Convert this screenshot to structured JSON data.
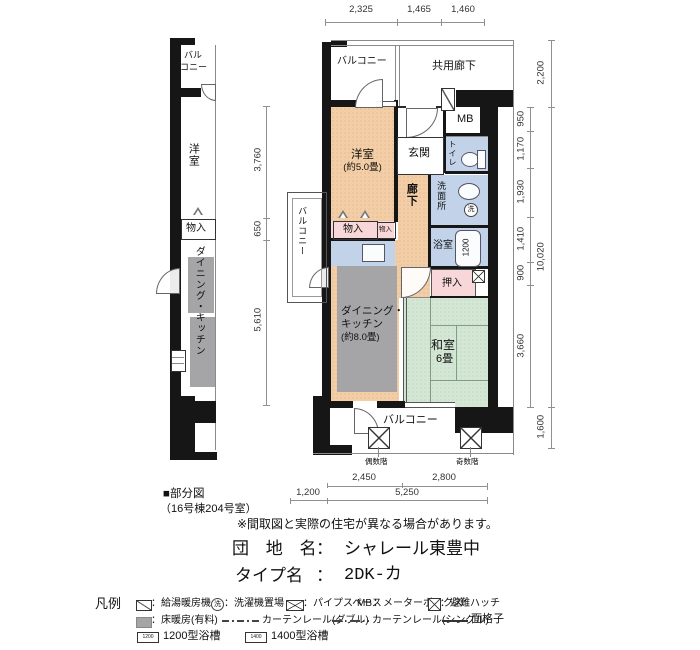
{
  "colors": {
    "western_room": "#f3cda5",
    "wet_area": "#c2d3e9",
    "storage": "#f7d7d7",
    "tatami": "#d4e7d5",
    "floor_heating": "#a5a5a7",
    "wall": "#161616"
  },
  "partial": {
    "caption1": "■部分図",
    "caption2": "（16号棟204号室）",
    "balcony1": "バル",
    "balcony2": "コニー",
    "youshitsu": "洋室",
    "monoire": "物入",
    "dk": "ダイニング・キッチン"
  },
  "main": {
    "balcony_top": "バルコニー",
    "kyoyo_roka": "共用廊下",
    "mb": "MB",
    "youshitsu1": "洋室",
    "youshitsu2": "(約5.0畳)",
    "genkan": "玄関",
    "roka": "廊下",
    "toilet": "トイレ",
    "senmenjo": "洗面所",
    "laundry": "洗",
    "yokushitsu": "浴室",
    "bath1200": "1200",
    "monoire": "物入",
    "monoire2": "物入",
    "oshiire": "押入",
    "dk1": "ダイニング・",
    "dk2": "キッチン",
    "dk3": "(約8.0畳)",
    "washitsu1": "和室",
    "washitsu2": "6畳",
    "balcony_side": "バルコニー",
    "balcony_bottom": "バルコニー",
    "hatch_even": "偶数階",
    "hatch_odd": "奇数階"
  },
  "dims": {
    "top": [
      "2,325",
      "1,465",
      "1,460"
    ],
    "left": [
      "3,760",
      "650",
      "5,610"
    ],
    "right_a": [
      "950",
      "1,170",
      "1,930",
      "1,410",
      "900",
      "3,660"
    ],
    "right_b": [
      "2,200",
      "10,020",
      "1,600"
    ],
    "bottom_a": [
      "2,450",
      "2,800"
    ],
    "bottom_b": [
      "1,200",
      "5,250"
    ]
  },
  "info": {
    "disclaimer": "※間取図と実際の住宅が異なる場合があります。",
    "name_label": "団 地 名",
    "name_colon": "：",
    "name_value": "シャレール東豊中",
    "type_label": "タイプ名",
    "type_colon": "：",
    "type_value": "2DK-カ"
  },
  "legend": {
    "heading": "凡例",
    "r1_1": "：給湯暖房機",
    "r1_2sym": "洗",
    "r1_2": "：洗濯機置場",
    "r1_3": "：パイプスペース",
    "r1_4pre": "MB",
    "r1_4": "：メーターボックス",
    "r1_5": "：避難ハッチ",
    "r2_1": "：床暖房(有料)",
    "r2_2": "カーテンレール(ダブル)",
    "r2_3": "カーテンレール(シングル)",
    "r2_4": "面格子",
    "r3_1sym": "1200",
    "r3_1": "1200型浴槽",
    "r3_2sym": "1400",
    "r3_2": "1400型浴槽"
  }
}
